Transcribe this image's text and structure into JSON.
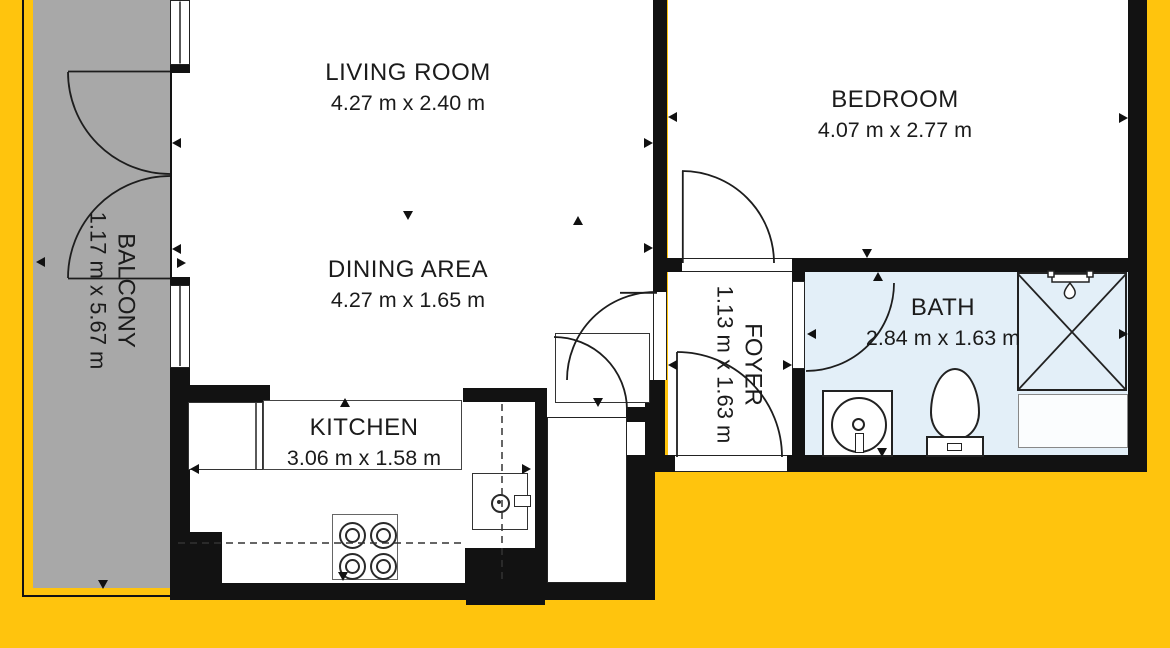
{
  "title": "Apartment floor plan",
  "colors": {
    "background": "#FFC40D",
    "balcony_floor": "#A8A8A8",
    "bath_floor": "#E3EFF8",
    "wall": "#121212",
    "line": "#222222",
    "text": "#1B1B1B"
  },
  "rooms": {
    "living": {
      "name": "LIVING ROOM",
      "dims": "4.27 m x 2.40 m"
    },
    "dining": {
      "name": "DINING AREA",
      "dims": "4.27 m x 1.65 m"
    },
    "kitchen": {
      "name": "KITCHEN",
      "dims": "3.06 m x 1.58 m"
    },
    "bedroom": {
      "name": "BEDROOM",
      "dims": "4.07 m x 2.77 m"
    },
    "bath": {
      "name": "BATH",
      "dims": "2.84 m x 1.63 m"
    },
    "foyer": {
      "name": "FOYER",
      "dims": "1.13 m x 1.63 m"
    },
    "balcony": {
      "name": "BALCONY",
      "dims": "1.17 m x 5.67 m"
    }
  },
  "icons": {
    "shower": "square-with-x-cross",
    "shower_head": "bar-with-water-drop",
    "toilet": "oval-bowl-with-tank",
    "washing_machine": "square-with-drum-circle",
    "stove": "square-with-4-burner-circles",
    "kitchen_sink": "square-with-tap-circle",
    "wardrobe": "thin-rectangle",
    "window": "double-line-rectangle",
    "door_swing": "quarter-arc",
    "direction_marker": "small-black-triangle"
  }
}
